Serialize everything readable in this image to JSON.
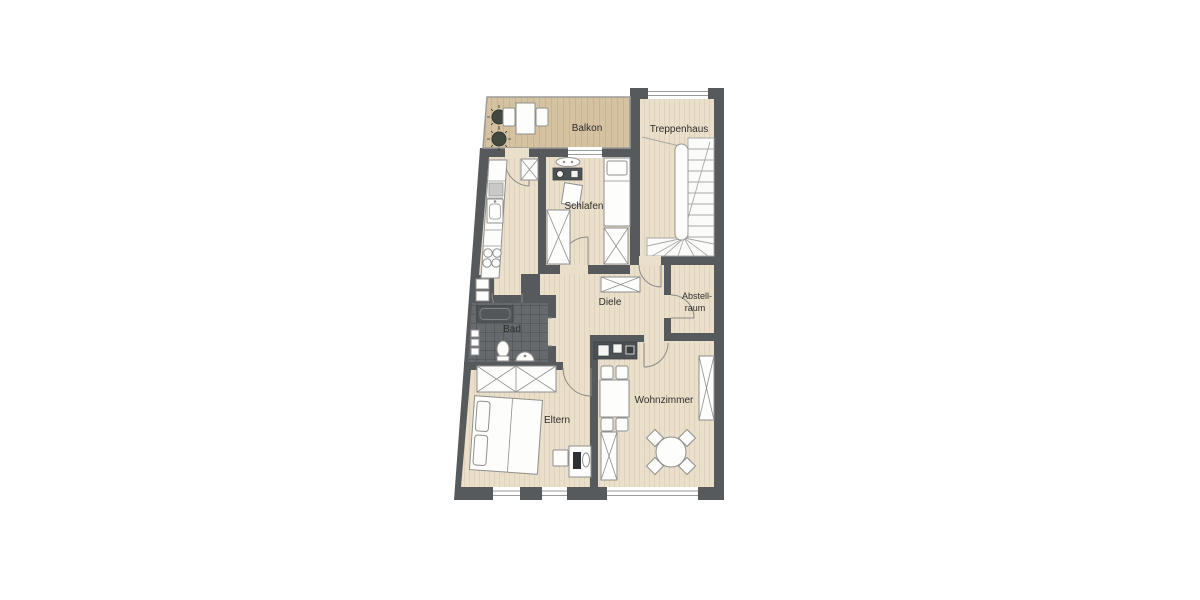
{
  "plan": {
    "title": "apartment-floor-plan",
    "rooms": {
      "balkon": {
        "label": "Balkon"
      },
      "treppenhaus": {
        "label": "Treppenhaus"
      },
      "schlafen": {
        "label": "Schlafen"
      },
      "diele": {
        "label": "Diele"
      },
      "abstellraum": {
        "label_line1": "Abstell-",
        "label_line2": "raum"
      },
      "bad": {
        "label": "Bad"
      },
      "eltern": {
        "label": "Eltern"
      },
      "wohnzimmer": {
        "label": "Wohnzimmer"
      }
    },
    "colors": {
      "background": "#ffffff",
      "wall": "#565a5d",
      "floor": "#eadfca",
      "floor_stripe": "#d5c5a4",
      "balcony_floor": "#d5c2a1",
      "balcony_stripe": "#bfa983",
      "bathroom_floor": "#66696d",
      "bathroom_grid": "#585b5e",
      "furniture_fill": "#fdfdfc",
      "furniture_stroke": "#8f8f8d",
      "dark_fixture": "#4c5154",
      "plant_green": "#424a40",
      "label_text": "#2e2e2e"
    }
  }
}
